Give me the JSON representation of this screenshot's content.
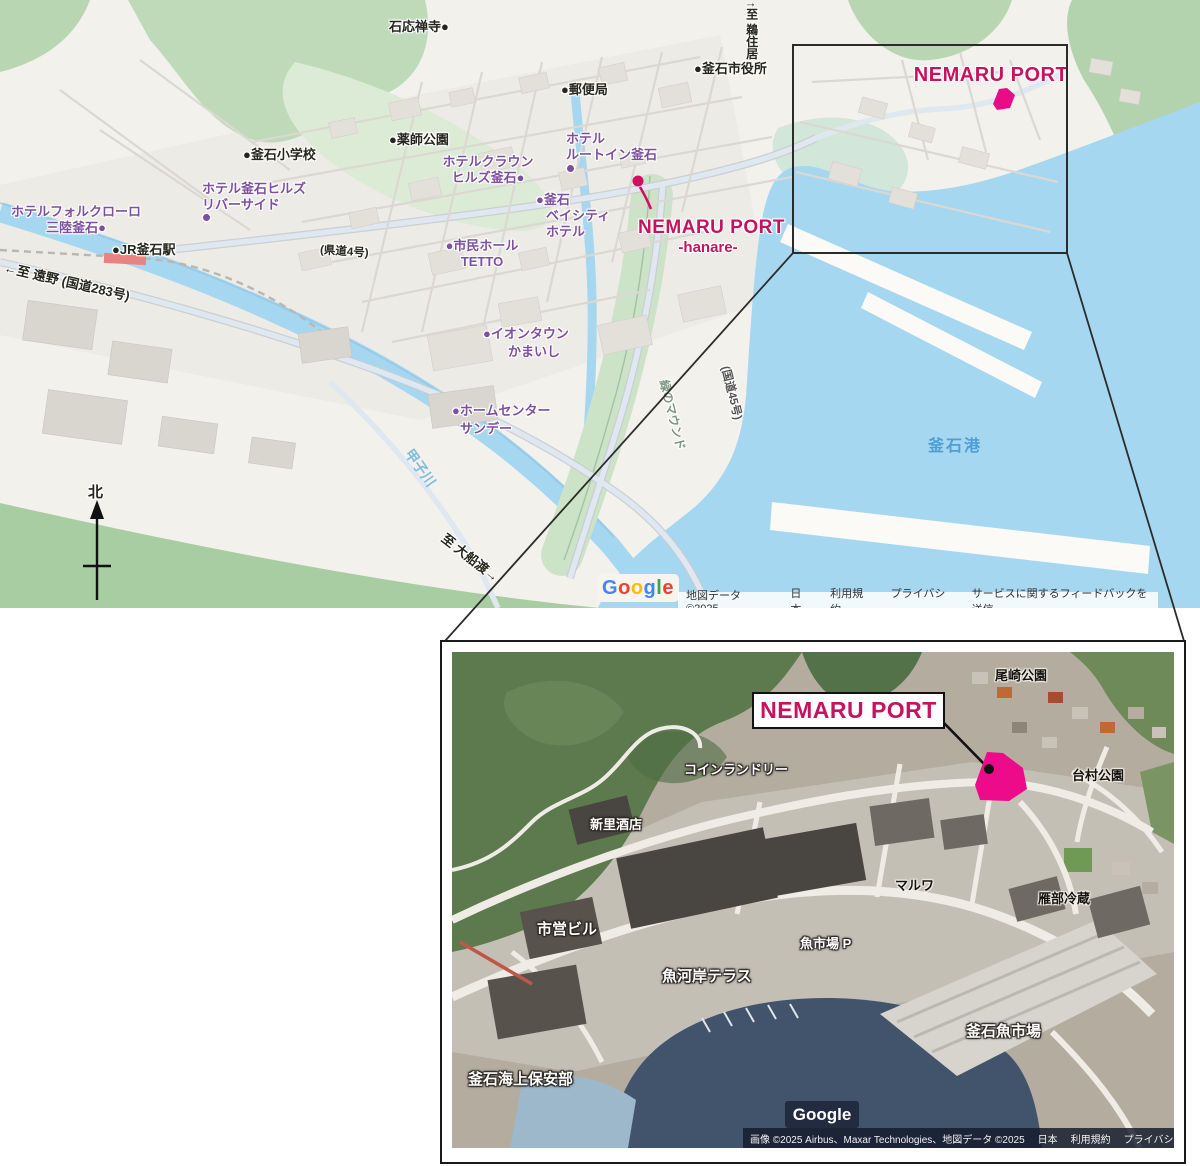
{
  "colors": {
    "nemaru_magenta": "#c6135f",
    "site_polygon_pink": "#ee0b8b",
    "poi_purple": "#7d4fa0",
    "poi_black": "#26261f",
    "sea_blue": "#a6d7f0",
    "sea_label_blue": "#4d9fd6",
    "river_label_blue": "#7fbce0",
    "forest_green": "#b9d6b3",
    "harbor_dark_blue": "#42546c",
    "google_letter_colors": [
      "#4285F4",
      "#EA4335",
      "#FBBC05",
      "#4285F4",
      "#34A853",
      "#EA4335"
    ]
  },
  "main_map": {
    "labels": {
      "sekio_zenji": "石応禅寺●",
      "yubinkyoku": "●郵便局",
      "shiyakusho": "●釜石市役所",
      "unosumai": "↑至 鵜住居",
      "yakushi_koen": "●薬師公園",
      "shogakko": "●釜石小学校",
      "hotel_crown_1": "ホテルクラウン",
      "hotel_crown_2": "ヒルズ釜石●",
      "hotel_route_inn_1": "ホテル",
      "hotel_route_inn_2": "ルートイン釜石",
      "hotel_hills_1": "ホテル釜石ヒルズ",
      "hotel_hills_2": "リバーサイド",
      "folkloro_1": "ホテルフォルクローロ",
      "folkloro_2": "三陸釜石●",
      "jr_station": "●JR釜石駅",
      "route283": "←至 遠野 (国道283号)",
      "kendo4": "(県道4号)",
      "baycity_1": "●釜石",
      "baycity_2": "ベイシティ",
      "baycity_3": "ホテル",
      "tetto_1": "●市民ホール",
      "tetto_2": "TETTO",
      "nemaru_hanare_1": "NEMARU PORT",
      "nemaru_hanare_2": "-hanare-",
      "aeon_1": "●イオンタウン",
      "aeon_2": "かまいし",
      "sunday_1": "●ホームセンター",
      "sunday_2": "サンデー",
      "kasshigawa": "甲子川",
      "midori_mound": "緑のマウンド",
      "route45": "(国道45号)",
      "ofunato": "至 大船渡→",
      "north": "北",
      "kamaishi_port_sea": "釜石港",
      "nemaru_port_main": "NEMARU PORT"
    },
    "google_logo": {
      "g1": "G",
      "g2": "o",
      "g3": "o",
      "g4": "g",
      "g5": "l",
      "g6": "e"
    },
    "attribution": {
      "map_data": "地図データ ©2025",
      "country": "日本",
      "terms": "利用規約",
      "privacy": "プライバシー",
      "feedback": "サービスに関するフィードバックを送信"
    }
  },
  "inset_map": {
    "labels": {
      "ozaki_park": "尾崎公園",
      "nemaru_box": "NEMARU PORT",
      "daimura_park": "台村公園",
      "coin_laundry": "コインランドリー",
      "niisato_saketen": "新里酒店",
      "maruwa": "マルワ",
      "ganbe_reizo": "雁部冷蔵",
      "shiei_building": "市営ビル",
      "fish_market_parking": "魚市場 P",
      "uogashi_terrace": "魚河岸テラス",
      "kamaishi_fish_market": "釜石魚市場",
      "coast_guard": "釜石海上保安部"
    },
    "attribution": {
      "google": "Google",
      "credit": "画像 ©2025 Airbus、Maxar Technologies、地図データ ©2025",
      "country": "日本",
      "terms": "利用規約",
      "privacy": "プライバシー"
    }
  }
}
